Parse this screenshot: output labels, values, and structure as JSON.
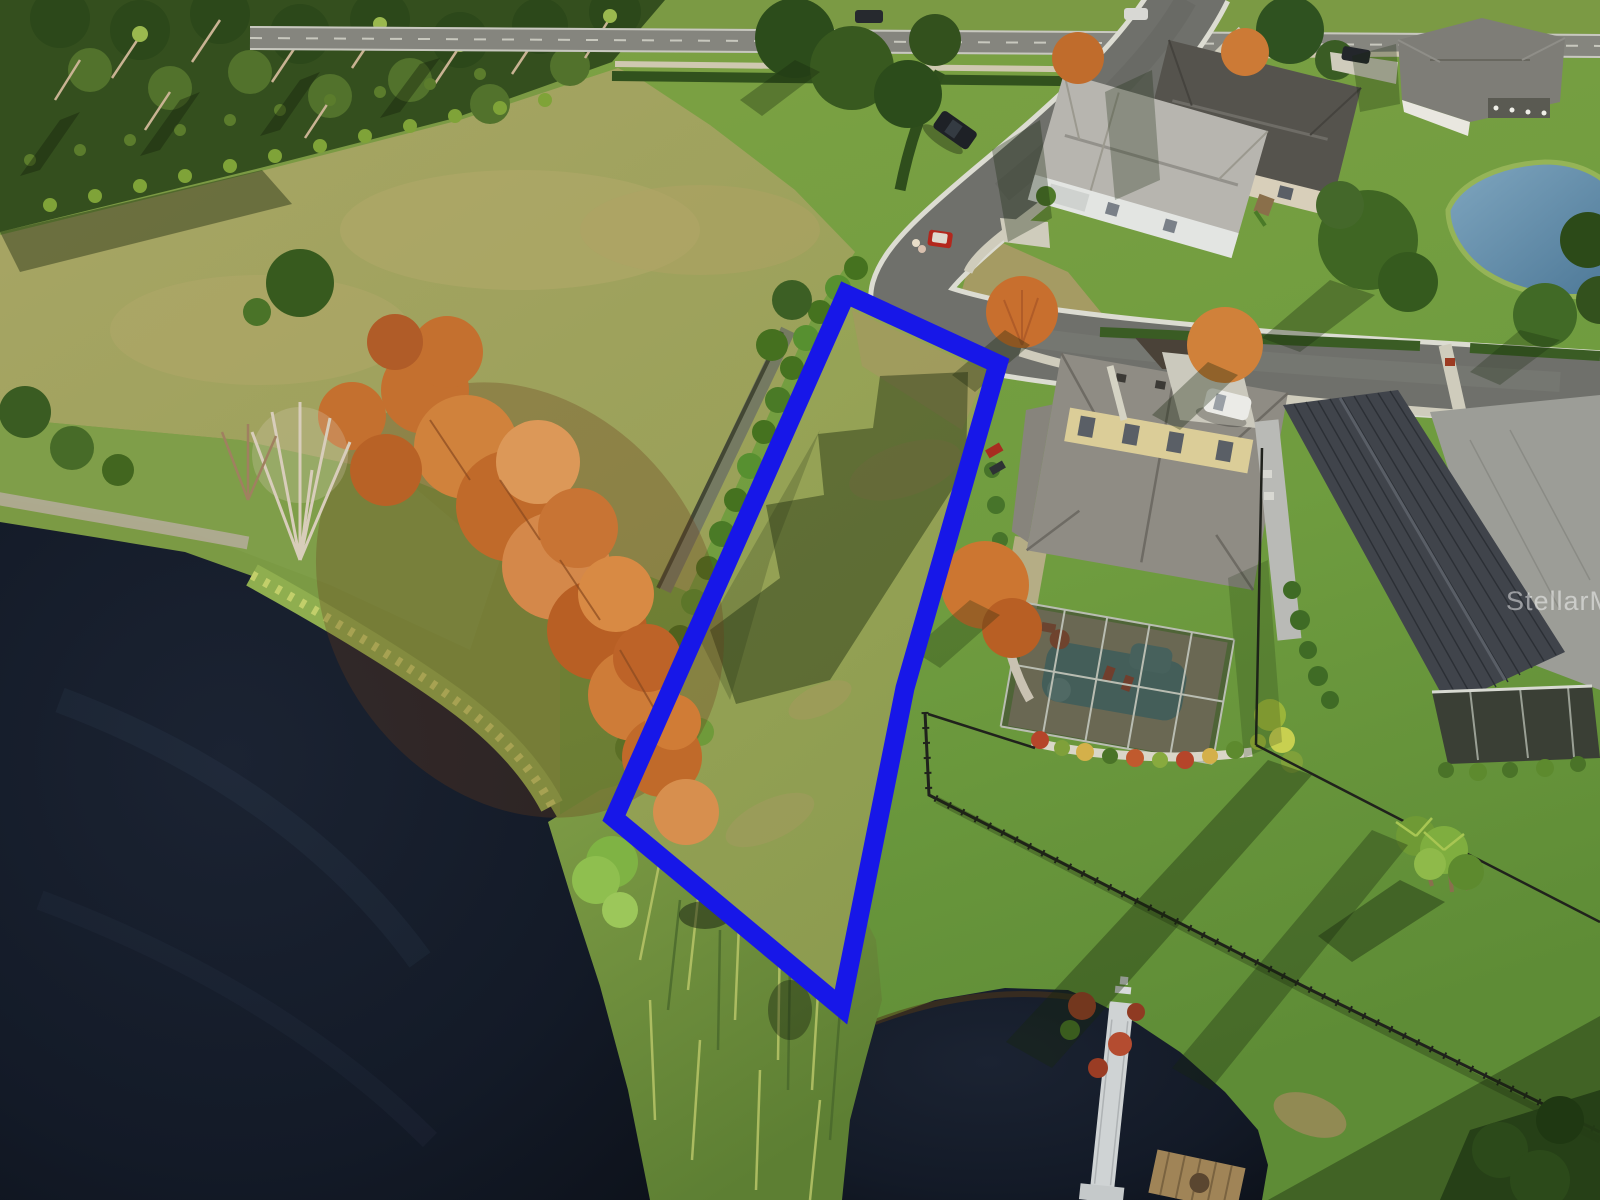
{
  "image": {
    "width": 1600,
    "height": 1200,
    "kind": "aerial-drone-real-estate-photo",
    "description": "Aerial photo of a vacant waterfront lot outlined in blue beside suburban homes, a curving cul-de-sac street, orange cypress trees and a dark lake"
  },
  "watermark": {
    "text": "StellarMLS",
    "color": "rgba(255,255,255,0.48)"
  },
  "lot_outline": {
    "color": "#1717e8",
    "stroke_width": 19,
    "points": "846,294 998,364 905,688 841,1007 614,818"
  },
  "features": [
    "dark lake water",
    "shoreline reeds",
    "orange cypress trees",
    "bare tree",
    "palm nursery rows",
    "scrub field",
    "lakeside walking path",
    "curving residential street",
    "main road",
    "red utility cart with two people",
    "dark pickup truck",
    "white suv in driveway",
    "house with screened pool enclosure",
    "swimming pool",
    "red pool chairs",
    "metal roof house",
    "screened lanai",
    "top neighborhood houses",
    "retention pond",
    "black yard fences",
    "white boat dock",
    "wood platform",
    "palm cluster",
    "blue lot boundary outline"
  ],
  "palette": {
    "lot_outline_blue": "#1717e8",
    "lake_dark": "#10151f",
    "lawn_green": "#6f9c3f",
    "field_tan": "#a8a463",
    "cypress_orange": "#c9752f",
    "asphalt": "#6f706b",
    "curb": "#dcdcd2",
    "roof_gray": "#8f8c84",
    "pool_teal": "#4f8897",
    "pond_blue": "#55809f",
    "fence_black": "#20221c",
    "dock_white": "#cfd3d4"
  }
}
